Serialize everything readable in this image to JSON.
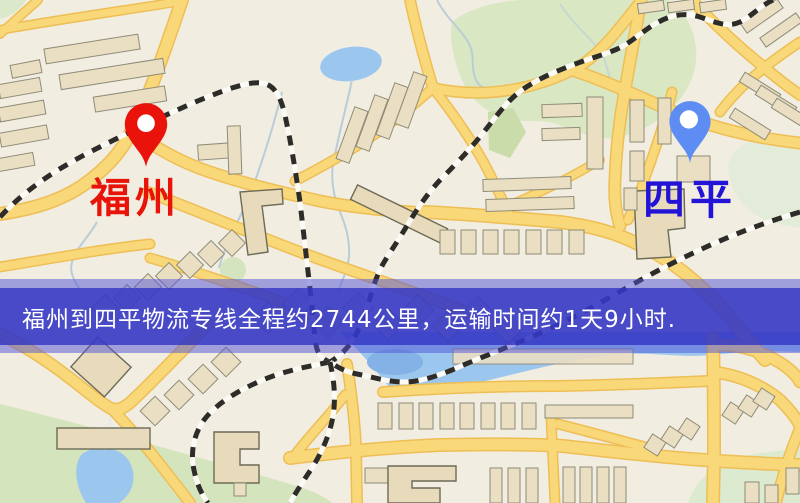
{
  "map": {
    "origin_marker": {
      "label": "福州"
    },
    "destination_marker": {
      "label": "四平"
    },
    "banner": {
      "text": "福州到四平物流专线全程约2744公里，运输时间约1天9小时."
    },
    "route": {
      "origin": "福州",
      "destination": "四平",
      "distance_text": "约2744公里",
      "duration_text": "约1天9小时"
    },
    "colors": {
      "origin_pin": "#ea130b",
      "origin_label": "#e8140a",
      "destination_pin": "#5d8df3",
      "destination_label": "#2213d6",
      "banner_background": "#3234c2",
      "banner_text": "#ffffff",
      "land": "#f1ede0",
      "road": "#f8d87c",
      "water": "#9cc7ee",
      "park": "#d9e7c4",
      "building": "#eadec4",
      "railway": "#2e2c28"
    }
  }
}
